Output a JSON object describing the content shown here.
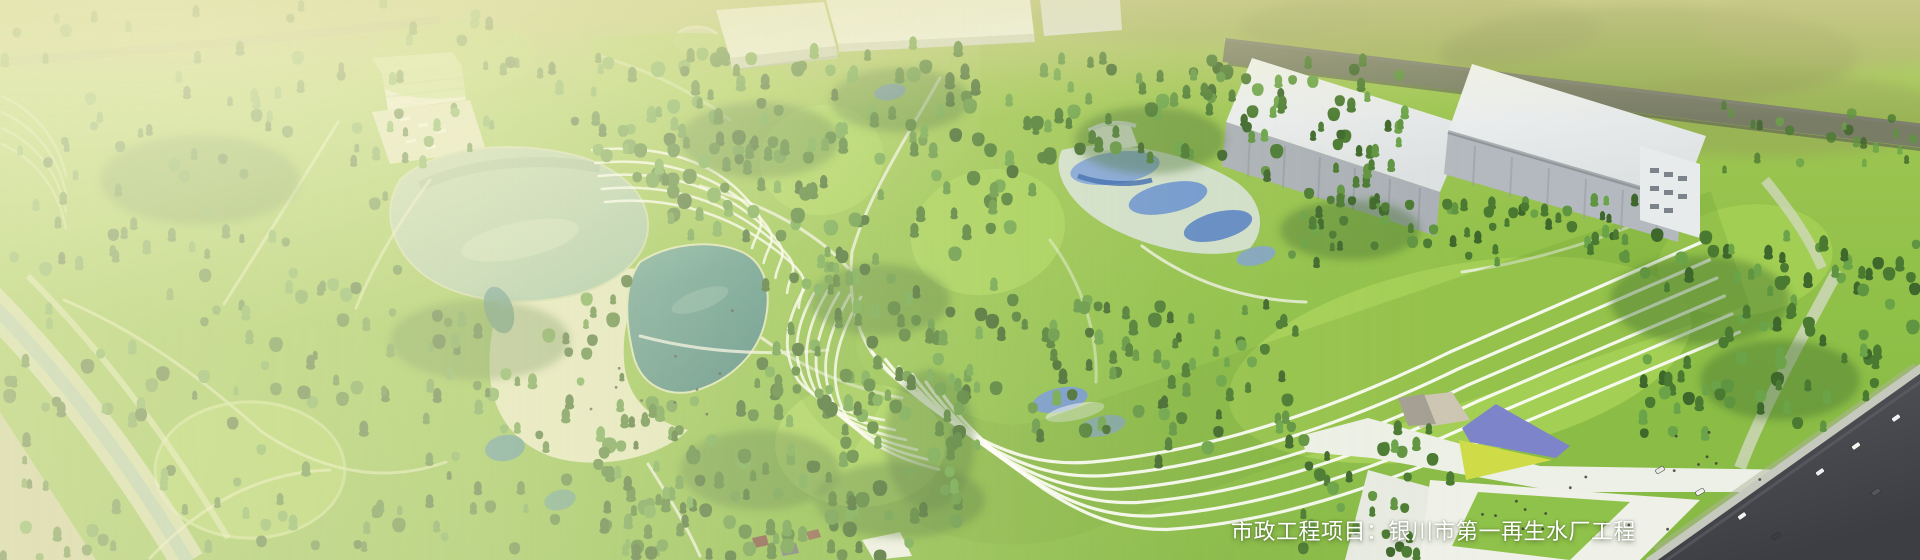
{
  "banner": {
    "caption": {
      "text": "市政工程项目：银川市第一再生水厂工程",
      "label": "市政工程项目",
      "separator": "：",
      "project_name": "银川市第一再生水厂工程",
      "color": "#ffffff"
    }
  },
  "scene": {
    "type": "aerial-architectural-rendering",
    "subject": "reclaimed-water-plant-campus-with-wetland-park",
    "features": [
      "forest-park",
      "lakes-and-ponds",
      "central-beach-plaza",
      "wetland-treatment-pools",
      "terraced-contour-lawns",
      "treatment-plant-halls",
      "office-building",
      "entrance-plaza-with-colored-canopies",
      "perimeter-roads-with-cars"
    ],
    "palette": {
      "grass": "#8fc048",
      "lawn_bright": "#a4d055",
      "tree_dark": "#3e672b",
      "tree_mid": "#4a7a31",
      "tree_light": "#5f9440",
      "tree_highlight": "#6aa348",
      "lake_teal": "#5e9c92",
      "pond_deep": "#41807c",
      "wetland_blue": "#6b93cf",
      "plaza_sand": "#e0e5bd",
      "building_white": "#eff1f0",
      "building_face_gray": "#aab0b6",
      "road_dark": "#45464b",
      "path_white": "#f2f4ea",
      "accent_purple": "#7d84c9",
      "accent_yellow": "#cfdc48",
      "wash_overlay": "#f6f3cd"
    }
  }
}
